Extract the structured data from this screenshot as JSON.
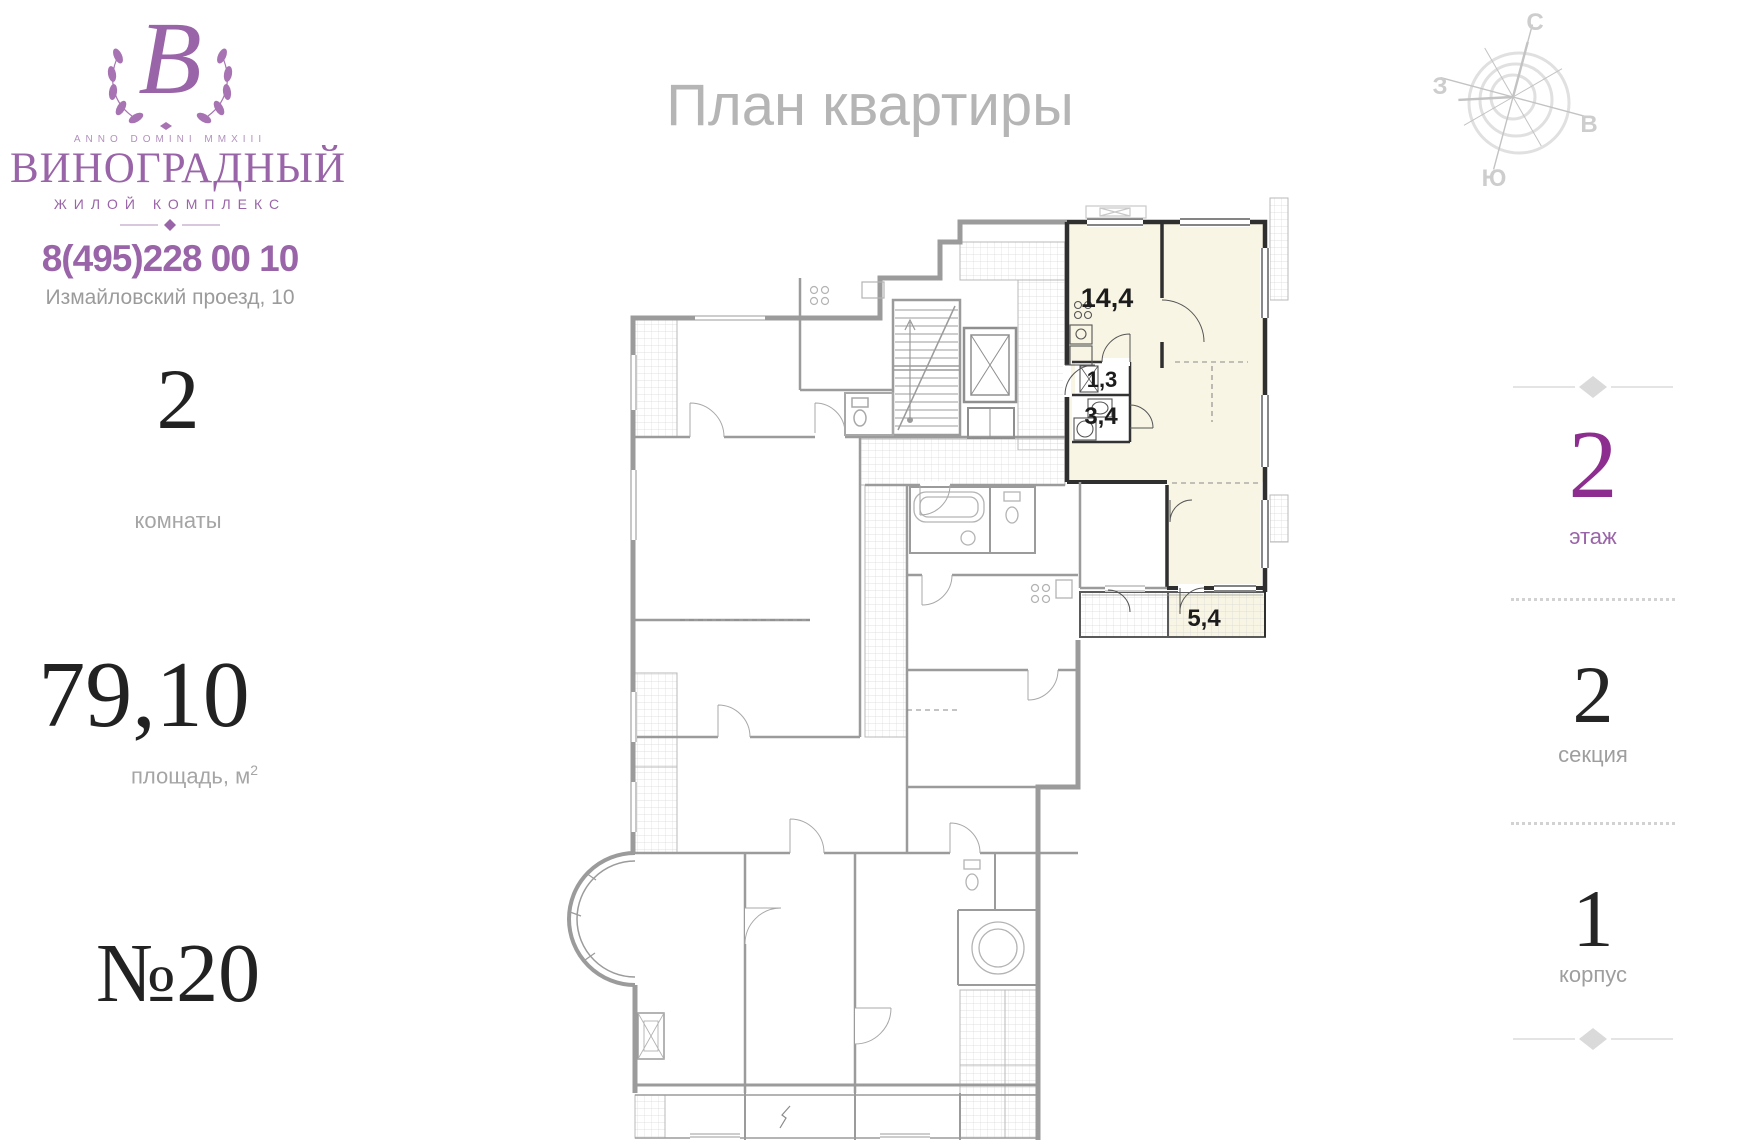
{
  "brand": {
    "monogram": "В",
    "anno": "ANNO DOMINI MMXIII",
    "name": "ВИНОГРАДНЫЙ",
    "tagline": "ЖИЛОЙ КОМПЛЕКС",
    "phone": "8(495)228 00 10",
    "address": "Измайловский проезд, 10",
    "accent_color": "#9a64a8"
  },
  "page": {
    "title": "План квартиры"
  },
  "apartment": {
    "rooms_value": "2",
    "rooms_label": "комнаты",
    "area_value": "79,10",
    "area_label": "площадь, м",
    "area_sup": "2",
    "number": "№20"
  },
  "location": {
    "floor_value": "2",
    "floor_label": "этаж",
    "floor_color": "#8e2d90",
    "section_value": "2",
    "section_label": "секция",
    "building_value": "1",
    "building_label": "корпус"
  },
  "compass": {
    "north": "С",
    "east": "В",
    "south": "Ю",
    "west": "З"
  },
  "plan": {
    "highlight_color": "#f8f5e4",
    "room_areas": [
      {
        "id": "kitchen",
        "label": "14,4"
      },
      {
        "id": "hallway",
        "label": "1,3"
      },
      {
        "id": "bathroom",
        "label": "3,4"
      },
      {
        "id": "loggia",
        "label": "5,4"
      }
    ]
  }
}
